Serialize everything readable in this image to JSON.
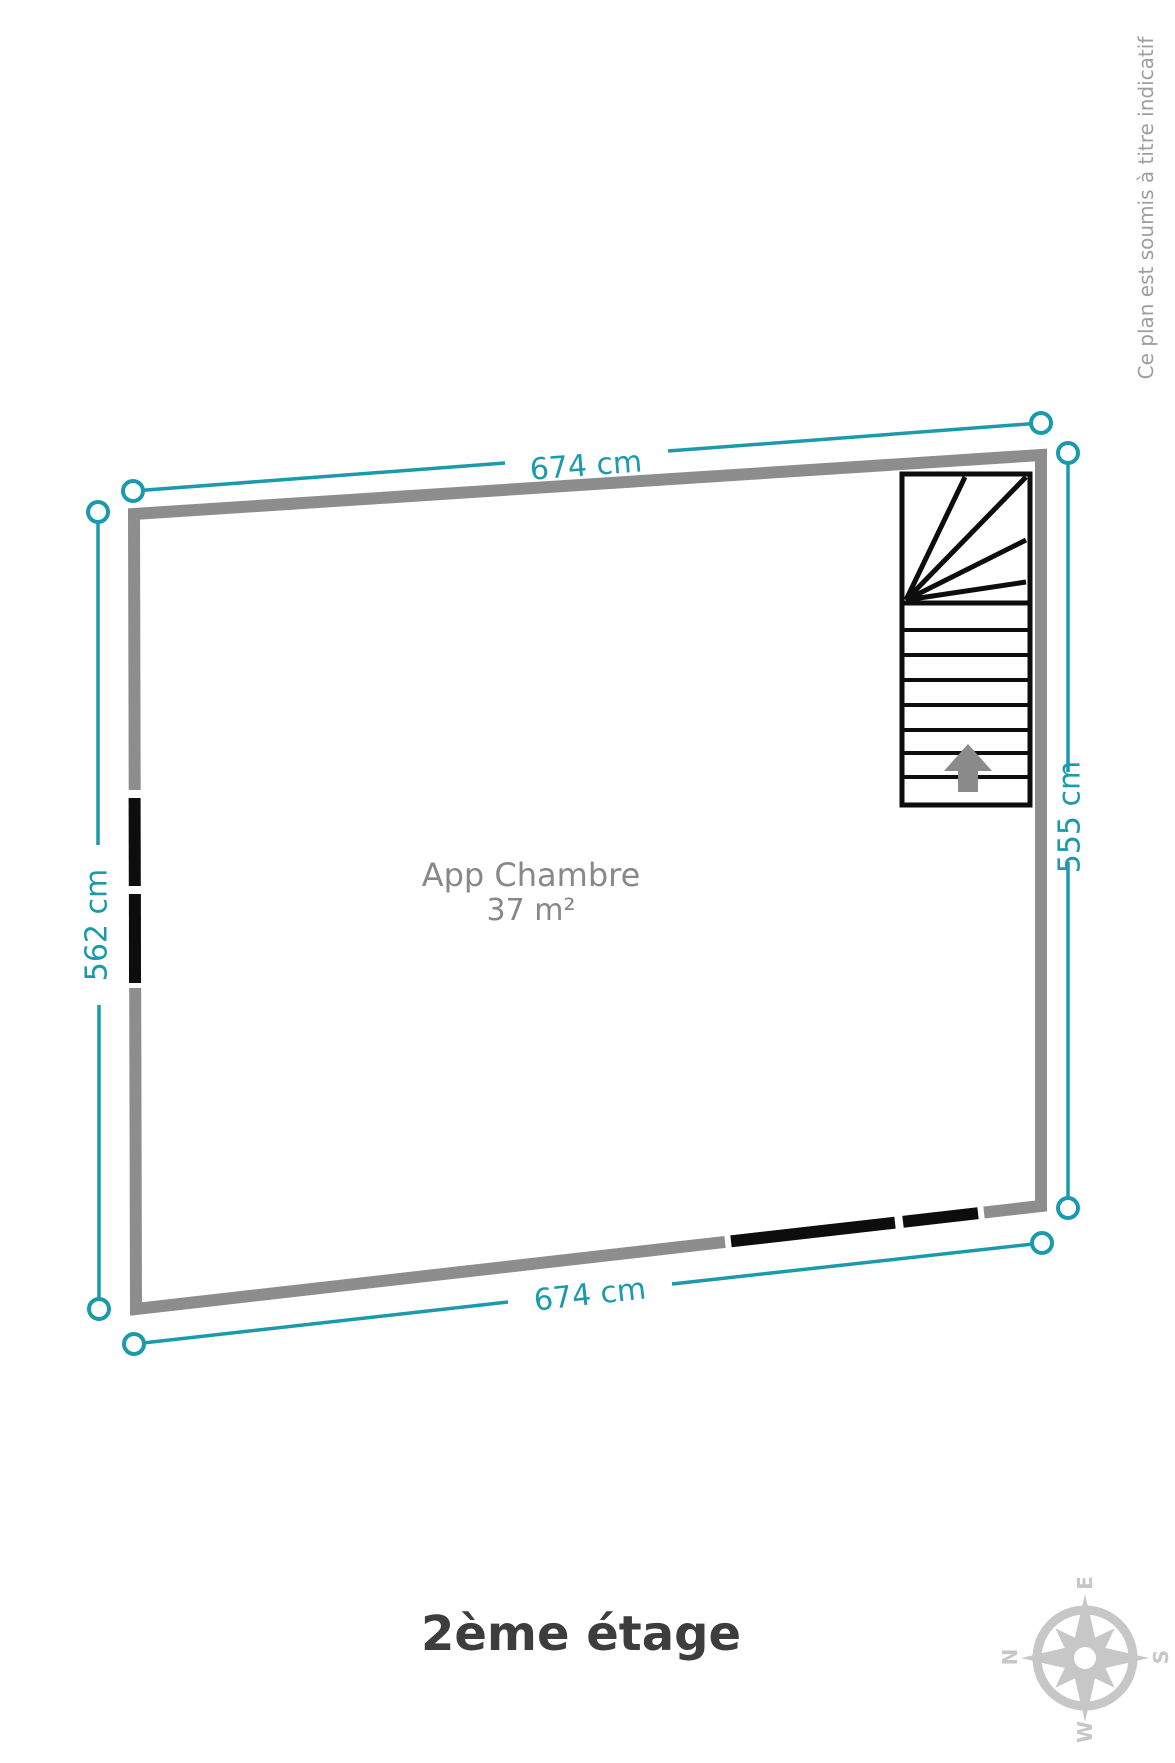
{
  "page": {
    "title": "2ème étage",
    "disclaimer": "Ce plan est soumis à titre indicatif"
  },
  "room": {
    "name": "App Chambre",
    "area": "37 m²"
  },
  "dimensions": {
    "top": "674 cm",
    "bottom": "674 cm",
    "left": "562 cm",
    "right": "555 cm"
  },
  "compass": {
    "n": "N",
    "e": "E",
    "s": "S",
    "w": "W"
  },
  "colors": {
    "teal": "#1b9aab",
    "wall": "#8d8d8d",
    "door": "#0d0d0d",
    "stair": "#0d0d0d",
    "arrow": "#8a8a8a",
    "labelgray": "#888888",
    "titlegray": "#3d3d3d",
    "disclaimer": "#9e9e9e",
    "compass": "#c7c7c7"
  }
}
